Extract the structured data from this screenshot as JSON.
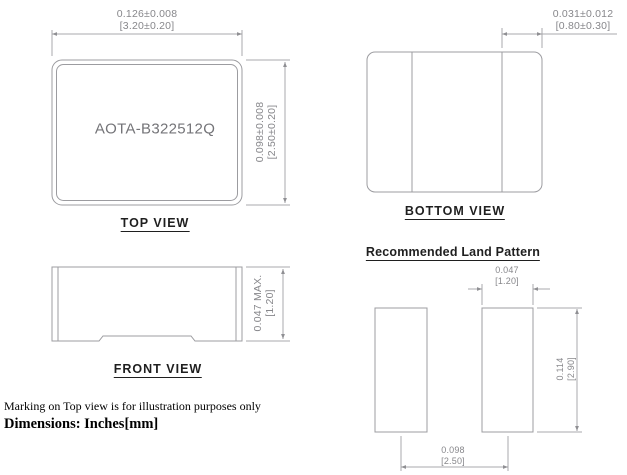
{
  "drawing": {
    "part_number": "AOTA-B322512Q",
    "views": {
      "top": {
        "label": "TOP VIEW",
        "width_dim_in": "0.126±0.008",
        "width_dim_mm": "[3.20±0.20]",
        "height_dim_in": "0.098±0.008",
        "height_dim_mm": "[2.50±0.20]"
      },
      "bottom": {
        "label": "BOTTOM VIEW",
        "terminal_dim_in": "0.031±0.012",
        "terminal_dim_mm": "[0.80±0.30]"
      },
      "front": {
        "label": "FRONT VIEW",
        "height_dim_in": "0.047 MAX.",
        "height_dim_mm": "[1.20]"
      }
    },
    "land_pattern": {
      "title": "Recommended Land Pattern",
      "pad_width_in": "0.047",
      "pad_width_mm": "[1.20]",
      "pad_height_in": "0.114",
      "pad_height_mm": "[2.90]",
      "pad_pitch_in": "0.098",
      "pad_pitch_mm": "[2.50]"
    },
    "notes": {
      "marking": "Marking on Top view is for illustration purposes only",
      "units": "Dimensions: Inches[mm]"
    }
  },
  "colors": {
    "outline_line": "#9c9ca0",
    "dimension_line": "#a8a8ac",
    "dimension_text": "#87878b",
    "marking_text": "#747478",
    "label_text": "#1f1f1f",
    "note_text": "#000000",
    "background": "#ffffff"
  }
}
